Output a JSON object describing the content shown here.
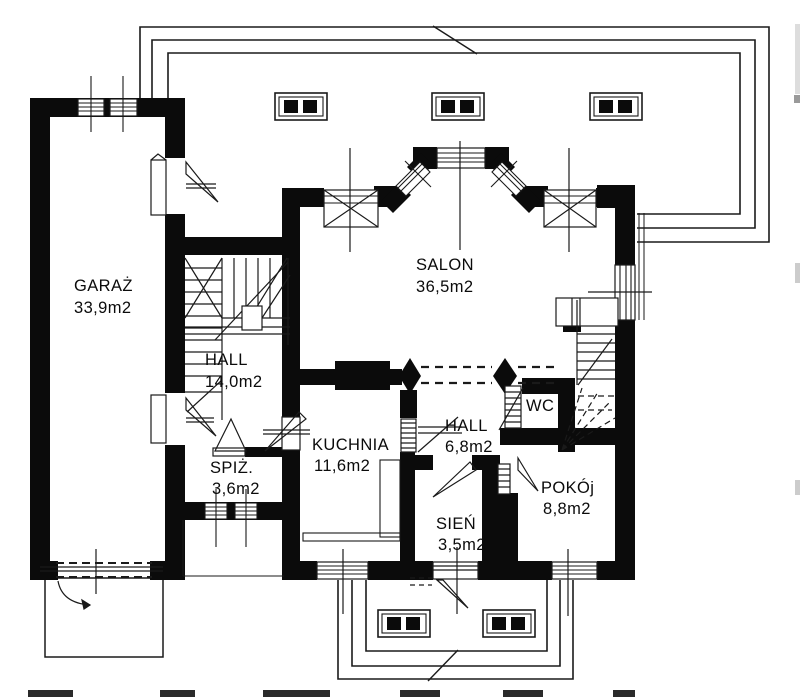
{
  "drawing": {
    "type": "architectural-floor-plan",
    "colors": {
      "ink": "#0b0b0b",
      "paper": "#ffffff"
    },
    "rooms": [
      {
        "name": "GARAŻ",
        "area": "33,9m2"
      },
      {
        "name": "SALON",
        "area": "36,5m2"
      },
      {
        "name": "HALL",
        "area": "14,0m2"
      },
      {
        "name": "KUCHNIA",
        "area": "11,6m2"
      },
      {
        "name": "HALL",
        "area": "6,8m2"
      },
      {
        "name": "WC",
        "area": ""
      },
      {
        "name": "SPIŻ.",
        "area": "3,6m2"
      },
      {
        "name": "SIEŃ",
        "area": "3,5m2"
      },
      {
        "name": "POKÓj",
        "area": "8,8m2"
      }
    ]
  }
}
